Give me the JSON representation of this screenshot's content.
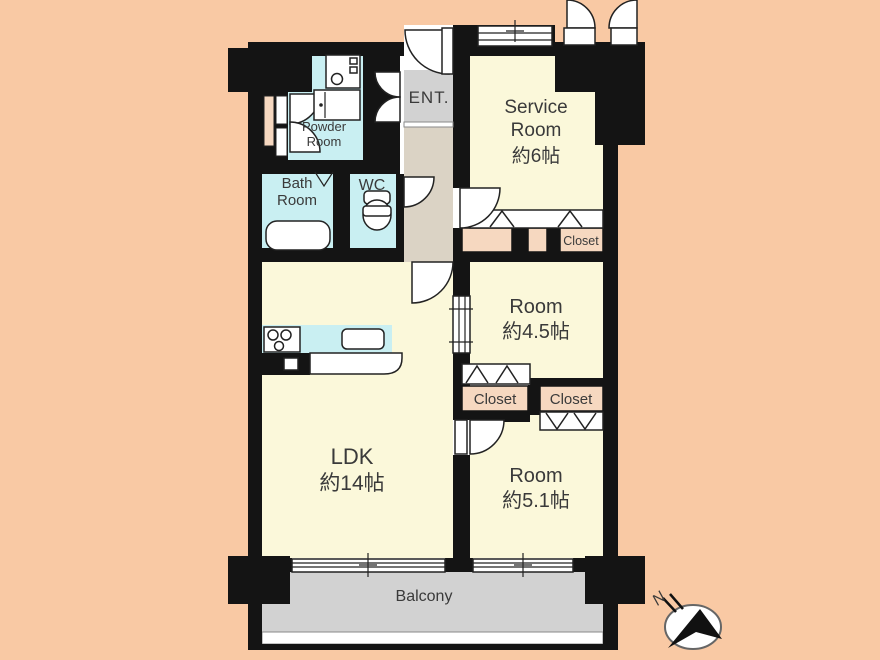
{
  "palette": {
    "background": "#f9c9a4",
    "wall": "#141414",
    "room_cream": "#fbf8da",
    "wet_area_cyan": "#c9eff2",
    "corridor_beige": "#dbd3c5",
    "entrance_gray": "#d2d2d2",
    "balcony_gray": "#d2d2d2",
    "closet_peach": "#f6d8c0",
    "label_text": "#3a3a3a"
  },
  "rooms": {
    "powder_room": {
      "lines": [
        "Powder",
        "Room"
      ]
    },
    "entrance": {
      "label": "ENT."
    },
    "service_room": {
      "lines": [
        "Service",
        "Room",
        "約6帖"
      ]
    },
    "bath_room": {
      "lines": [
        "Bath",
        "Room"
      ]
    },
    "wc": {
      "label": "WC"
    },
    "service_closet": {
      "label": "Closet"
    },
    "room_4_5": {
      "lines": [
        "Room",
        "約4.5帖"
      ]
    },
    "closet_left": {
      "label": "Closet"
    },
    "closet_right": {
      "label": "Closet"
    },
    "ldk": {
      "lines": [
        "LDK",
        "約14帖"
      ]
    },
    "room_5_1": {
      "lines": [
        "Room",
        "約5.1帖"
      ]
    },
    "balcony": {
      "label": "Balcony"
    }
  },
  "compass": {
    "north_label": "N"
  }
}
